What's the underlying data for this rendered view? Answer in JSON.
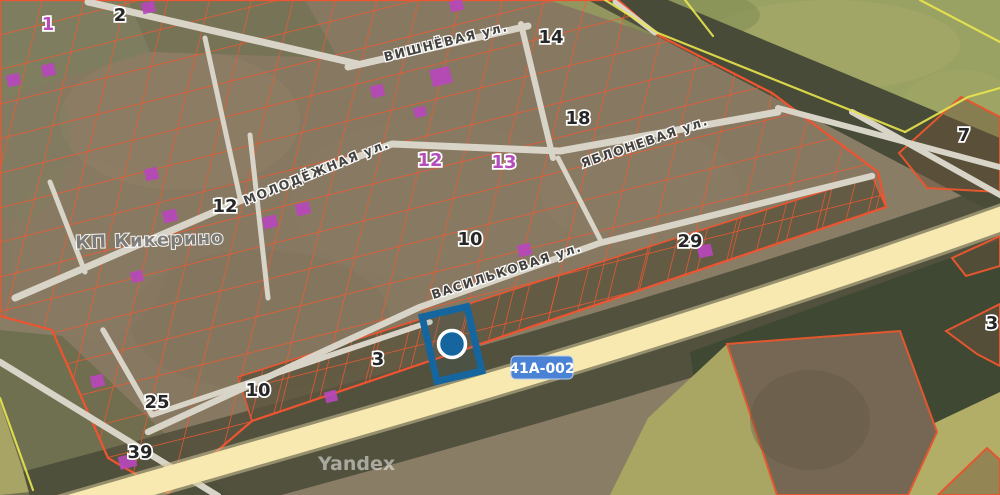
{
  "map": {
    "place_label": "КП Кикерино",
    "streets": [
      {
        "name": "ВИШНЁВАЯ ул."
      },
      {
        "name": "МОЛОДЁЖНАЯ ул."
      },
      {
        "name": "ЯБЛОНЕВАЯ ул."
      },
      {
        "name": "ВАСИЛЬКОВАЯ ул."
      }
    ],
    "numbers": [
      {
        "text": "1",
        "tone": "magenta"
      },
      {
        "text": "2",
        "tone": "black"
      },
      {
        "text": "14",
        "tone": "black"
      },
      {
        "text": "18",
        "tone": "black"
      },
      {
        "text": "12",
        "tone": "magenta"
      },
      {
        "text": "13",
        "tone": "magenta"
      },
      {
        "text": "12",
        "tone": "black"
      },
      {
        "text": "10",
        "tone": "black"
      },
      {
        "text": "29",
        "tone": "black"
      },
      {
        "text": "3",
        "tone": "black"
      },
      {
        "text": "10",
        "tone": "black"
      },
      {
        "text": "25",
        "tone": "black"
      },
      {
        "text": "39",
        "tone": "black"
      },
      {
        "text": "7",
        "tone": "black"
      },
      {
        "text": "3",
        "tone": "black"
      }
    ],
    "route_badge": "41А-002",
    "watermark": "Yandex",
    "colors": {
      "parcel_line": "#f2572e",
      "boundary_yellow": "#e9e44e",
      "building": "#b947bc",
      "selection_blue": "#15669f",
      "badge_bg": "#4a82d6",
      "highway": "#f7e9b0",
      "road": "#d9d4c8"
    }
  }
}
